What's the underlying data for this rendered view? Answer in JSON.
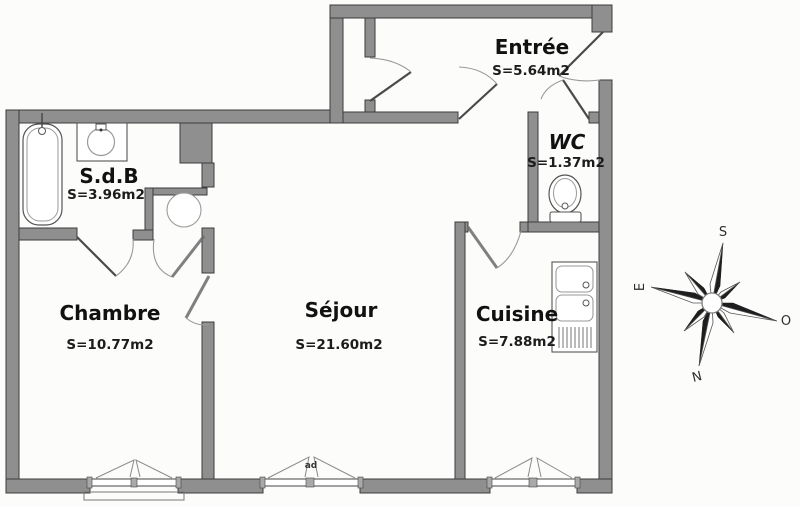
{
  "colors": {
    "wall": "#8f8f8f",
    "wall_edge": "#3c3c3c",
    "line": "#4a4a4a",
    "arc": "#999999",
    "bg": "#fcfdfb",
    "text": "#111111"
  },
  "rooms": [
    {
      "id": "entree",
      "name": "Entrée",
      "area": "S=5.64m2"
    },
    {
      "id": "wc",
      "name": "WC",
      "area": "S=1.37m2"
    },
    {
      "id": "sdb",
      "name": "S.d.B",
      "area": "S=3.96m2"
    },
    {
      "id": "chambre",
      "name": "Chambre",
      "area": "S=10.77m2"
    },
    {
      "id": "sejour",
      "name": "Séjour",
      "area": "S=21.60m2"
    },
    {
      "id": "cuisine",
      "name": "Cuisine",
      "area": "S=7.88m2"
    }
  ],
  "window_label": "ad",
  "compass": {
    "n": "N",
    "s": "S",
    "e": "E",
    "o": "O"
  },
  "fixtures": [
    "bathtub",
    "washbasin",
    "water-heater",
    "toilet",
    "kitchen-sink",
    "kitchen-drainboard"
  ]
}
